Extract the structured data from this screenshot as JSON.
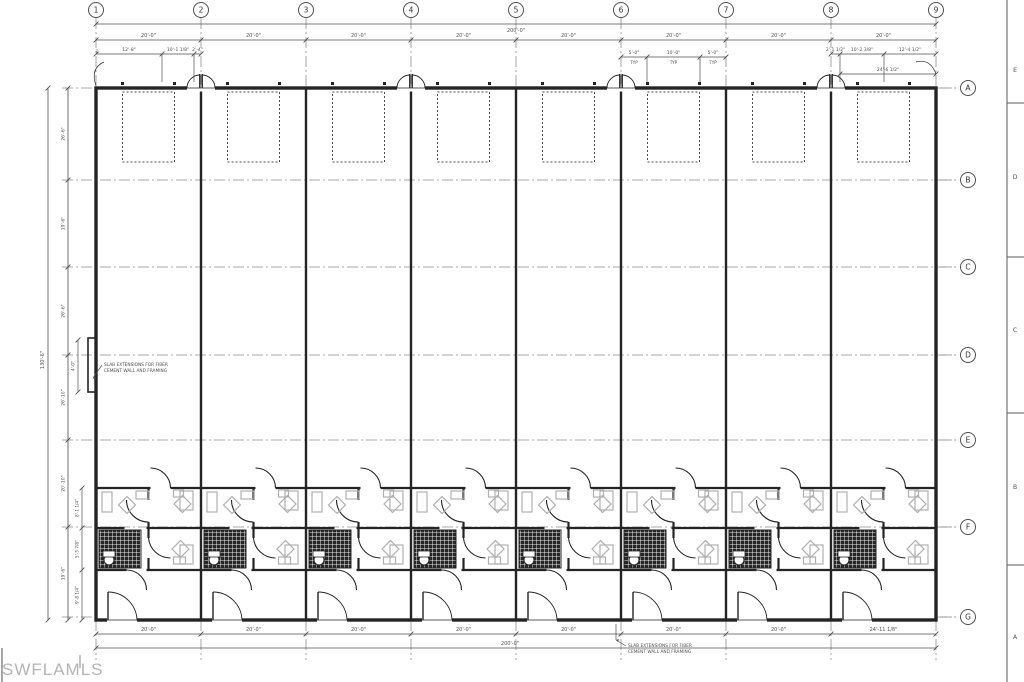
{
  "watermark": "SWFLAMLS",
  "plan": {
    "grid_columns": [
      "1",
      "2",
      "3",
      "4",
      "5",
      "6",
      "7",
      "8",
      "9"
    ],
    "grid_rows": [
      "A",
      "B",
      "C",
      "D",
      "E",
      "F",
      "G"
    ],
    "sheet_zone_letters": [
      "E",
      "D",
      "C",
      "B",
      "A"
    ],
    "dimensions": {
      "overall_width_top": "200'-0\"",
      "overall_width_bottom": "200'-0\"",
      "overall_height_left": "130'-6\"",
      "top_bays": [
        "20'-0\"",
        "20'-0\"",
        "20'-0\"",
        "20'-0\"",
        "20'-0\"",
        "20'-0\"",
        "20'-0\"",
        "20'-0\""
      ],
      "bottom_bays": [
        "20'-0\"",
        "20'-0\"",
        "20'-0\"",
        "20'-0\"",
        "20'-0\"",
        "20'-0\"",
        "20'-0\"",
        "24'-11 1/8\""
      ],
      "top_left_sub": [
        "12'-8\"",
        "10'-1 1/8\"",
        "2'-4\""
      ],
      "top_right_sub": [
        "2'-1 1/2\"",
        "10'-2 3/8\"",
        "12'-4 1/2\""
      ],
      "top_right_span": "24'-6 1/2\"",
      "typ_sub": [
        {
          "value": "5'-0\"",
          "tag": "TYP"
        },
        {
          "value": "10'-0\"",
          "tag": "TYP"
        },
        {
          "value": "5'-0\"",
          "tag": "TYP"
        }
      ],
      "left_segments": [
        "26'-6\"",
        "19'-6\"",
        "26'-6\"",
        "26'-10\"",
        "20'-10\"",
        "19'-6\""
      ],
      "left_inner": [
        "8'-1 1/4\"",
        "5'-5 7/8\"",
        "9'-8 1/4\""
      ],
      "left_jog": "4'-0\"",
      "top_left_corner": "4\""
    },
    "notes": {
      "slab_note_left": [
        "SLAB EXTENSIONS FOR FIBER",
        "CEMENT WALL AND FRAMING"
      ],
      "slab_note_bottom": [
        "SLAB EXTENSIONS FOR FIBER",
        "CEMENT WALL AND FRAMING"
      ]
    },
    "colors": {
      "line": "#242424",
      "dim": "#4f4f4f",
      "centerline": "#8f8f8f",
      "fixture": "#b0b0b0",
      "hatch": "#262626",
      "watermark": "#b4b4b4",
      "background": "#ffffff"
    }
  }
}
